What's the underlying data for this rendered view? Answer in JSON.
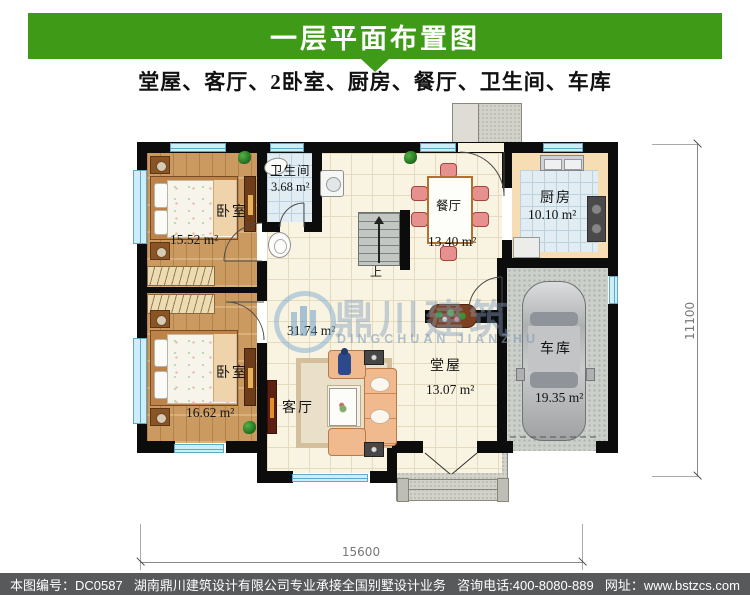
{
  "header": {
    "title": "一层平面布置图",
    "subtitle": "堂屋、客厅、2卧室、厨房、餐厅、卫生间、车库"
  },
  "rooms": {
    "bedroom1": {
      "name": "卧室",
      "area": "15.52 m²"
    },
    "bathroom": {
      "name": "卫生间",
      "area": "3.68 m²"
    },
    "dining": {
      "name": "餐厅",
      "area": "13.40 m²"
    },
    "kitchen": {
      "name": "厨房",
      "area": "10.10 m²"
    },
    "bedroom2": {
      "name": "卧室",
      "area": "16.62 m²"
    },
    "living": {
      "name": "客厅",
      "area": "31.74 m²"
    },
    "hall": {
      "name": "堂屋",
      "area": "13.07 m²"
    },
    "garage": {
      "name": "车库",
      "area": "19.35 m²"
    }
  },
  "plan": {
    "stairs_up": "上"
  },
  "dimensions": {
    "width": "15600",
    "height": "11100"
  },
  "watermark": {
    "cn": "鼎川建筑",
    "en": "DINGCHUAN JIANZHU"
  },
  "footer": {
    "code": "本图编号：DC0587",
    "company": "湖南鼎川建筑设计有限公司专业承接全国别墅设计业务",
    "phone": "咨询电话:400-8080-889",
    "site": "网址：www.bstzcs.com"
  },
  "colors": {
    "banner_green": "#3f9b17",
    "footer_gray": "#58595b",
    "window_blue": "#cdeef9"
  }
}
